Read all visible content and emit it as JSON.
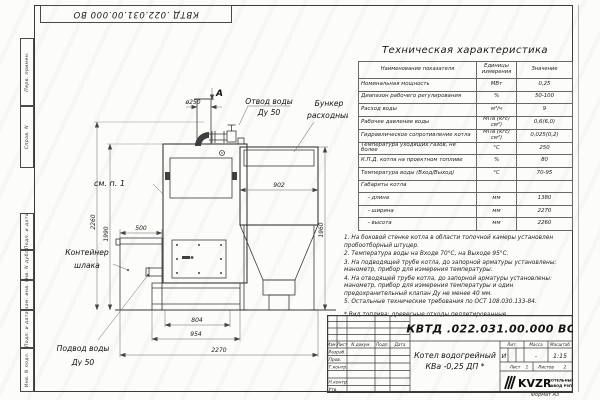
{
  "frame": {
    "left_labels": [
      "Перв. примен.",
      "Справ. N",
      "Подп. и дата",
      "Инв. N дубл.",
      "Взам. инв. N",
      "Подп. и дата",
      "Инв. N подл."
    ]
  },
  "table": {
    "title": "Техническая характеристика",
    "headers": [
      "Наименование показателя",
      "Единицы измерения",
      "Значение"
    ],
    "rows": [
      [
        "Номинальная мощность",
        "МВт",
        "0,25"
      ],
      [
        "Диапазон рабочего регулирования",
        "%",
        "50-100"
      ],
      [
        "Расход воды",
        "м³/ч",
        "9"
      ],
      [
        "Рабочее давление воды",
        "МПа (кгс/см²)",
        "0,6(6,0)"
      ],
      [
        "Гидравлическое сопротивление котла",
        "МПа (кгс/см²)",
        "0,025(0,2)"
      ],
      [
        "Температура уходящих газов, не более",
        "°С",
        "250"
      ],
      [
        "К.П.Д. котла на проектном топливе",
        "%",
        "80"
      ],
      [
        "Температура воды (Вход/Выход)",
        "°С",
        "70-95"
      ],
      [
        "Габариты котла",
        "",
        ""
      ],
      [
        "    - длина",
        "мм",
        "1380"
      ],
      [
        "    - ширина",
        "мм",
        "2270"
      ],
      [
        "    - высота",
        "мм",
        "2260"
      ]
    ]
  },
  "notes": {
    "items": [
      "1. На боковой стенке котла в области топочной камеры установлен пробоотборный штуцер.",
      "2. Температура воды на Входе 70°С, на Выходе 95°С.",
      "3. На подводящей трубе котла, до запорной арматуры установлены: манометр, прибор для измерения температуры.",
      "4. На отводящей трубе котла, до запорной арматуры установлены: манометр, прибор для измерения температуры и один предохранительный клапан Ду не менее 40 мм.",
      "5. Остальные технические требования по ОСТ 108.030.133-84."
    ],
    "fuel_note": "* Вид топлива: древесные отходы пеллетированные."
  },
  "drawing": {
    "view_label": "А",
    "labels": {
      "see_note": "см. п. 1",
      "water_out_1": "Отвод воды",
      "water_out_2": "Ду 50",
      "bunker_1": "Бункер",
      "bunker_2": "расходный",
      "slag_1": "Контейнер",
      "slag_2": "шлака",
      "water_in_1": "Подвод воды",
      "water_in_2": "Ду 50"
    },
    "dims": {
      "d250": "ø250",
      "d500": "500",
      "d804": "804",
      "d954": "954",
      "d2270": "2270",
      "d902": "902",
      "d1960": "1960",
      "d2260": "2260",
      "d1990": "1990"
    }
  },
  "titleblock": {
    "doc_number": "КВТД .022.031.00.000 ВО",
    "rev_header": [
      "Изм.",
      "Лист",
      "N докум.",
      "Подп.",
      "Дата"
    ],
    "roles": [
      "Разраб.",
      "Пров.",
      "Т.контр.",
      "Н.контр.",
      "Утв."
    ],
    "product_name_1": "Котел водогрейный",
    "product_name_2": "КВа -0,25  ДП *",
    "lit_header": [
      "Лит.",
      "Масса",
      "Масштаб"
    ],
    "lit_values": [
      "И",
      "-",
      "1:15"
    ],
    "sheet_label": "Лист",
    "sheet_value": "1",
    "sheets_label": "Листов",
    "sheets_value": "2",
    "logo_text": "KVZR",
    "company_line1": "КОТЕЛЬНЫЙ",
    "company_line2": "ЗАВОД РЭП",
    "format": "Формат А3"
  }
}
